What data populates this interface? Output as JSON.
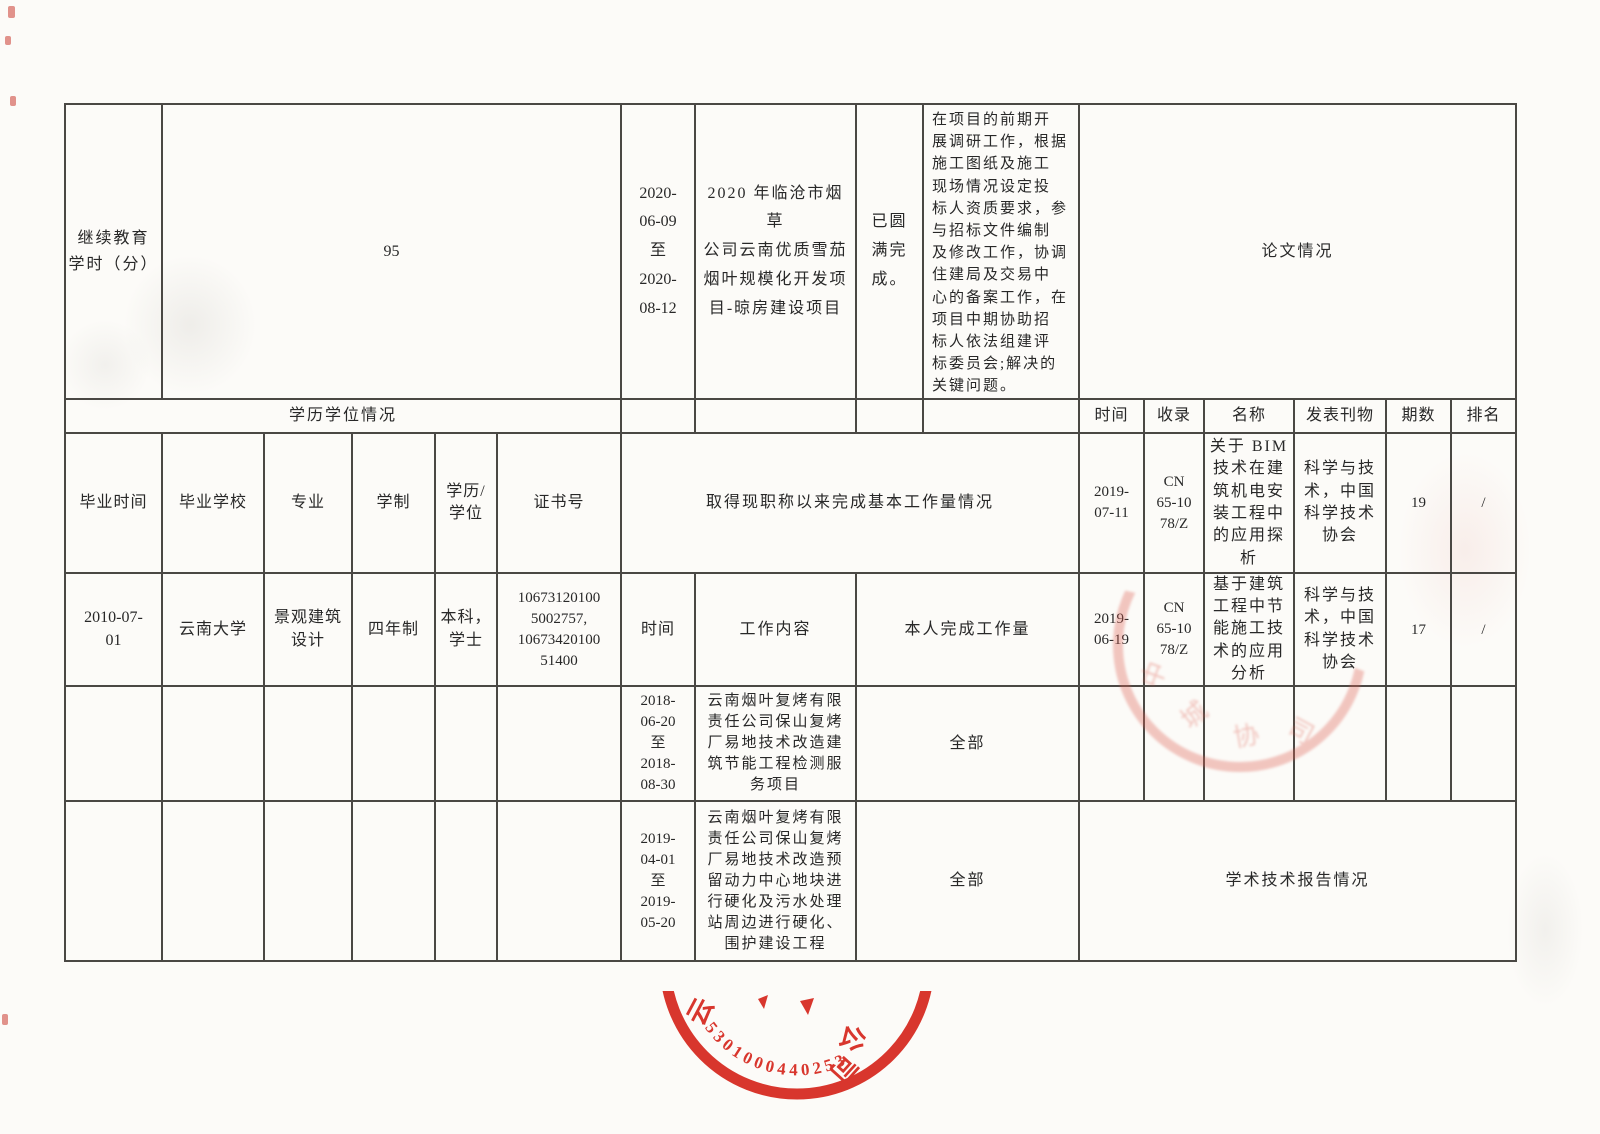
{
  "table": {
    "continuing_education": {
      "label": "继续教育\n学时（分）",
      "value": "95"
    },
    "current_project": {
      "period": "2020-\n06-09\n至\n2020-\n08-12",
      "project": "2020 年临沧市烟草\n公司云南优质雪茄\n烟叶规模化开发项\n目-晾房建设项目",
      "status": "已圆\n满完\n成。",
      "duty": "在项目的前期开\n展调研工作，根据\n施工图纸及施工\n现场情况设定投\n标人资质要求，参\n与招标文件编制\n及修改工作，协调\n住建局及交易中\n心的备案工作，在\n项目中期协助招\n标人依法组建评\n标委员会;解决的\n关键问题。"
    },
    "papers": {
      "section_title": "论文情况",
      "headers": [
        "时间",
        "收录",
        "名称",
        "发表刊物",
        "期数",
        "排名"
      ],
      "rows": [
        {
          "time": "2019-\n07-11",
          "index": "CN\n65-10\n78/Z",
          "name": "关于 BIM\n技术在建\n筑机电安\n装工程中\n的应用探\n析",
          "journal": "科学与技\n术，中国\n科学技术\n协会",
          "issue": "19",
          "rank": "/"
        },
        {
          "time": "2019-\n06-19",
          "index": "CN\n65-10\n78/Z",
          "name": "基于建筑\n工程中节\n能施工技\n术的应用\n分析",
          "journal": "科学与技\n术，中国\n科学技术\n协会",
          "issue": "17",
          "rank": "/"
        }
      ]
    },
    "education": {
      "section_title": "学历学位情况",
      "headers": [
        "毕业时间",
        "毕业学校",
        "专业",
        "学制",
        "学历/\n学位",
        "证书号"
      ],
      "row": {
        "graduation_date": "2010-07-\n01",
        "school": "云南大学",
        "major": "景观建筑\n设计",
        "duration": "四年制",
        "degree": "本科，\n学士",
        "certificate_no": "10673120100\n5002757,\n10673420100\n51400"
      }
    },
    "workload": {
      "section_title": "取得现职称以来完成基本工作量情况",
      "headers": [
        "时间",
        "工作内容",
        "本人完成工作量"
      ],
      "rows": [
        {
          "time": "2018-\n06-20\n至\n2018-\n08-30",
          "content": "云南烟叶复烤有限\n责任公司保山复烤\n厂易地技术改造建\n筑节能工程检测服\n务项目",
          "amount": "全部"
        },
        {
          "time": "2019-\n04-01\n至\n2019-\n05-20",
          "content": "云南烟叶复烤有限\n责任公司保山复烤\n厂易地技术改造预\n留动力中心地块进\n行硬化及污水处理\n站周边进行硬化、\n围护建设工程",
          "amount": "全部"
        }
      ]
    },
    "reports": {
      "section_title": "学术技术报告情况"
    }
  },
  "seals": {
    "bottom": {
      "number": "5301000440253",
      "chars": [
        "云",
        "公",
        "司"
      ],
      "color": "#d6281e"
    },
    "faint": {
      "chars": [
        "中",
        "城",
        "协",
        "司"
      ],
      "color": "#dd5f52"
    }
  }
}
